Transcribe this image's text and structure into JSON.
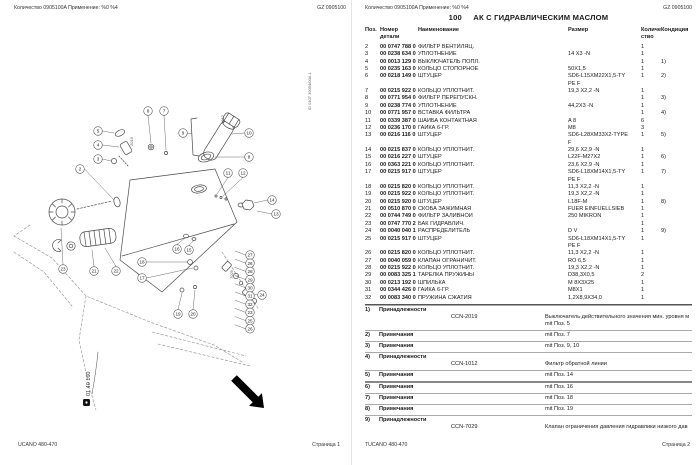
{
  "pages": {
    "left": {
      "header": {
        "left": "Количество 0905100A   Применение: %0 %4",
        "right": "GZ 0905100"
      },
      "footer": {
        "left": "UCANO 480-470",
        "right": "Страница 1"
      },
      "diagram": {
        "group_label": "01 40 160",
        "drawing_id": "ID 0107 39054/00A 1",
        "inline_refs": [
          {
            "t": "2019",
            "x": 133,
            "y": 146
          },
          {
            "t": "1012",
            "x": 224,
            "y": 124
          },
          {
            "t": "7029",
            "x": 233,
            "y": 279
          }
        ],
        "callouts": [
          {
            "n": "2",
            "x": 80,
            "y": 169
          },
          {
            "n": "5",
            "x": 98,
            "y": 131
          },
          {
            "n": "4",
            "x": 98,
            "y": 145
          },
          {
            "n": "3",
            "x": 98,
            "y": 159
          },
          {
            "n": "6",
            "x": 148,
            "y": 111
          },
          {
            "n": "7",
            "x": 164,
            "y": 111
          },
          {
            "n": "9",
            "x": 183,
            "y": 133
          },
          {
            "n": "10",
            "x": 249,
            "y": 133
          },
          {
            "n": "8",
            "x": 249,
            "y": 157
          },
          {
            "n": "11",
            "x": 228,
            "y": 173
          },
          {
            "n": "12",
            "x": 243,
            "y": 173
          },
          {
            "n": "14",
            "x": 272,
            "y": 200
          },
          {
            "n": "13",
            "x": 276,
            "y": 214
          },
          {
            "n": "16",
            "x": 177,
            "y": 249
          },
          {
            "n": "15",
            "x": 189,
            "y": 250
          },
          {
            "n": "18",
            "x": 142,
            "y": 262
          },
          {
            "n": "17",
            "x": 142,
            "y": 278
          },
          {
            "n": "19",
            "x": 178,
            "y": 314
          },
          {
            "n": "20",
            "x": 193,
            "y": 314
          },
          {
            "n": "23",
            "x": 63,
            "y": 269
          },
          {
            "n": "21",
            "x": 94,
            "y": 271
          },
          {
            "n": "22",
            "x": 116,
            "y": 271
          },
          {
            "n": "24",
            "x": 262,
            "y": 295
          }
        ],
        "strip": {
          "x": 250,
          "start_y": 255,
          "step": 8.2,
          "numbers": [
            "27",
            "26",
            "28",
            "29",
            "30",
            "31",
            "32",
            "23",
            "25",
            "26"
          ]
        }
      }
    },
    "right": {
      "header": {
        "left": "Количество 0905100A   Применение: %0 %4",
        "right": "GZ 0905100"
      },
      "footer": {
        "left": "TUCANO 480-470",
        "right": "Страница 2"
      },
      "title": {
        "number": "100",
        "text": "АК С ГИДРАВЛИЧЕСКИМ МАСЛОМ"
      },
      "table": {
        "headers": {
          "pos": "Поз.",
          "part": "Номер детали",
          "name": "Наименование",
          "size": "Размер",
          "qty": "Количе\nство",
          "cond": "Кондиция"
        },
        "rows": [
          [
            "2",
            "00 0747 788 0",
            "ФИЛЬТР ВЕНТИЛЯЦ.",
            "",
            "1",
            ""
          ],
          [
            "3",
            "00 0238 634 0",
            "УПЛОТНЕНИЕ",
            "14  X3  -N",
            "1",
            ""
          ],
          [
            "4",
            "00 0013 129 0",
            "ВЫКЛЮЧАТЕЛЬ ПОПЛ.",
            "",
            "1",
            "1)"
          ],
          [
            "5",
            "00 0235 163 0",
            "КОЛЬЦО СТОПОРНОЕ",
            "50X1,5",
            "1",
            ""
          ],
          [
            "6",
            "00 0218 149 0",
            "ШТУЦЕР",
            "SD6-L15XM22X1,5-TY\nPE F",
            "1",
            "2)"
          ],
          [
            "7",
            "00 0215 922 0",
            "КОЛЬЦО УПЛОТНИТ.",
            "19,3 X2,2 -N",
            "1",
            ""
          ],
          [
            "8",
            "00 0771 954 0",
            "ФИЛЬТР ПЕРЕПУСКН.",
            "",
            "1",
            "3)"
          ],
          [
            "9",
            "00 0238 774 0",
            "УПЛОТНЕНИЕ",
            "44,2X3  -N",
            "1",
            ""
          ],
          [
            "10",
            "00 0771 957 0",
            "ВСТАВКА ФИЛЬТРА",
            "",
            "1",
            "4)"
          ],
          [
            "11",
            "00 0339 387 0",
            "ШАЙБА КОНТАКТНАЯ",
            "A 8",
            "6",
            ""
          ],
          [
            "12",
            "00 0236 170 0",
            "ГАЙКА 6-ГР.",
            "M8",
            "3",
            ""
          ],
          [
            "13",
            "00 0216 116 0",
            "ШТУЦЕР",
            "SD6-L28XM33X2-TYPE\nF",
            "1",
            "5)"
          ],
          [
            "14",
            "00 0215 837 0",
            "КОЛЬЦО УПЛОТНИТ.",
            "29,6 X2,9 -N",
            "1",
            ""
          ],
          [
            "15",
            "00 0216 227 0",
            "ШТУЦЕР",
            "L22F-M27X2",
            "1",
            "6)"
          ],
          [
            "16",
            "00 0363 221 0",
            "КОЛЬЦО УПЛОТНИТ.",
            "23,6 X2,9 -N",
            "1",
            ""
          ],
          [
            "17",
            "00 0215 917 0",
            "ШТУЦЕР",
            "SD6-L18XM14X1,5-TY\nPE F",
            "1",
            "7)"
          ],
          [
            "18",
            "00 0215 820 0",
            "КОЛЬЦО УПЛОТНИТ.",
            "11,3 X2,2 -N",
            "1",
            ""
          ],
          [
            "19",
            "00 0215 922 0",
            "КОЛЬЦО УПЛОТНИТ.",
            "19,3 X2,2 -N",
            "1",
            ""
          ],
          [
            "20",
            "00 0215 920 0",
            "ШТУЦЕР",
            "L18F-M",
            "1",
            "8)"
          ],
          [
            "21",
            "00 0510 870 0",
            "СКОБА ЗАЖИМНАЯ",
            "FUER EINFUELLSIEB",
            "1",
            ""
          ],
          [
            "22",
            "00 0744 749 0",
            "ФИЛЬТР ЗАЛИВНОЙ",
            "250 MIKRON",
            "1",
            ""
          ],
          [
            "23",
            "00 0747 770 2",
            "БАК ГИДРАВЛИЧ.",
            "",
            "1",
            ""
          ],
          [
            "24",
            "00 0040 040 1",
            "РАСПРЕДЕЛИТЕЛЬ",
            "D V",
            "1",
            "9)"
          ],
          [
            "25",
            "00 0215 917 0",
            "ШТУЦЕР",
            "SD6-L18XM14X1,5-TY\nPE F",
            "1",
            ""
          ],
          [
            "26",
            "00 0215 820 0",
            "КОЛЬЦО УПЛОТНИТ.",
            "11,3 X2,2 -N",
            "1",
            ""
          ],
          [
            "27",
            "00 0040 059 0",
            "КЛАПАН ОГРАНИЧИТ.",
            "RO 6,5",
            "1",
            ""
          ],
          [
            "28",
            "00 0215 922 0",
            "КОЛЬЦО УПЛОТНИТ.",
            "19,3 X2,2 -N",
            "1",
            ""
          ],
          [
            "29",
            "00 0083 325 1",
            "ТАРЕЛКА ПРУЖИНЫ",
            "D38,3X0,5",
            "2",
            ""
          ],
          [
            "30",
            "00 0213 192 0",
            "ШПИЛЬКА",
            "M 8X3X25",
            "1",
            ""
          ],
          [
            "31",
            "00 0344 426 0",
            "ГАЙКА 6-ГР.",
            "M8X1",
            "1",
            ""
          ],
          [
            "32",
            "00 0083 340 0",
            "ПРУЖИНА СЖАТИЯ",
            "1,2X8,9X34,0",
            "1",
            ""
          ]
        ]
      },
      "footnotes": [
        {
          "num": "1)",
          "label": "Принадлежности",
          "ccn": "CCN-2019",
          "desc": "Выключатель действительного значения мин. уровня м",
          "desc2": "mit Поз. 5"
        },
        {
          "num": "2)",
          "label": "Примечания",
          "desc": "mit Поз. 7"
        },
        {
          "num": "3)",
          "label": "Примечания",
          "desc": "mit Поз. 9, 10"
        },
        {
          "num": "4)",
          "label": "Принадлежности",
          "ccn": "CCN-1012",
          "desc": "Фильтр обратной линии"
        },
        {
          "num": "5)",
          "label": "Примечания",
          "desc": "mit Поз. 14"
        },
        {
          "num": "6)",
          "label": "Примечания",
          "desc": "mit Поз. 16"
        },
        {
          "num": "7)",
          "label": "Примечания",
          "desc": "mit Поз. 18"
        },
        {
          "num": "8)",
          "label": "Примечания",
          "desc": "mit Поз. 19"
        },
        {
          "num": "9)",
          "label": "Принадлежности",
          "ccn": "CCN-7029",
          "desc": "Клапан ограничения давления гидравлики низкого дав"
        }
      ]
    }
  },
  "colors": {
    "diagram_stroke": "#4a4a4a",
    "rule": "#555",
    "separator": "#aaa"
  }
}
